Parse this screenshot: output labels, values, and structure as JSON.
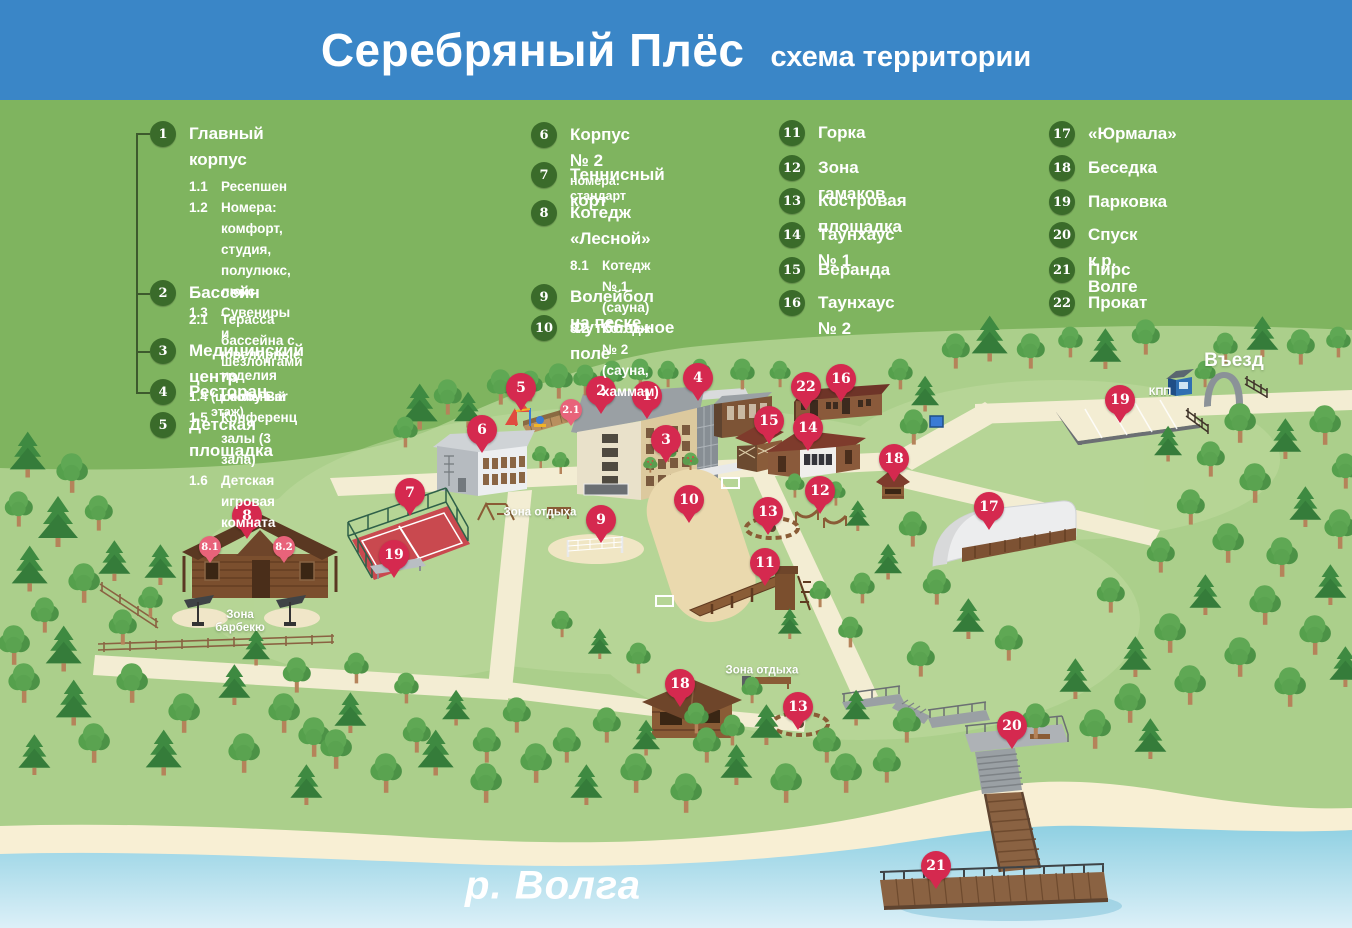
{
  "header": {
    "title": "Серебряный Плёс",
    "subtitle": "схема территории"
  },
  "legend": {
    "columns": [
      {
        "items": [
          {
            "num": "1",
            "label": "Главный корпус",
            "subs": [
              {
                "num": "1.1",
                "label": "Ресепшен"
              },
              {
                "num": "1.2",
                "label": "Номера: комфорт, студия, полулюкс, люкс"
              },
              {
                "num": "1.3",
                "label": "Сувениры и ювелирные изделия"
              },
              {
                "num": "1.4",
                "label": "Lobby Bar"
              },
              {
                "num": "1.5",
                "label": "Конференц залы (3 зала)"
              },
              {
                "num": "1.6",
                "label": "Детская игровая комната"
              }
            ]
          },
          {
            "num": "2",
            "label": "Бассейн",
            "subs": [
              {
                "num": "2.1",
                "label": "Терасса бассейна с шезлонгами"
              }
            ]
          },
          {
            "num": "3",
            "label": "Медицинский центр",
            "note": "(цокольный этаж)"
          },
          {
            "num": "4",
            "label": "Ресторан"
          },
          {
            "num": "5",
            "label": "Детская площадка"
          }
        ]
      },
      {
        "items": [
          {
            "num": "6",
            "label": "Корпус № 2",
            "note": "номера: стандарт"
          },
          {
            "num": "7",
            "label": "Теннисный корт"
          },
          {
            "num": "8",
            "label": "Котедж «Лесной»",
            "subs": [
              {
                "num": "8.1",
                "label": "Котедж № 1 (сауна)"
              },
              {
                "num": "8.2",
                "label": "Котедж № 2\n(сауна, хаммам)"
              }
            ]
          },
          {
            "num": "9",
            "label": "Волейбол на песке"
          },
          {
            "num": "10",
            "label": "Футбольное поле"
          }
        ]
      },
      {
        "items": [
          {
            "num": "11",
            "label": "Горка"
          },
          {
            "num": "12",
            "label": "Зона гамаков"
          },
          {
            "num": "13",
            "label": "Костровая площадка"
          },
          {
            "num": "14",
            "label": "Таунхаус № 1"
          },
          {
            "num": "15",
            "label": "Веранда"
          },
          {
            "num": "16",
            "label": "Таунхаус № 2"
          }
        ]
      },
      {
        "items": [
          {
            "num": "17",
            "label": "«Юрмала»"
          },
          {
            "num": "18",
            "label": "Беседка"
          },
          {
            "num": "19",
            "label": "Парковка"
          },
          {
            "num": "20",
            "label": "Спуск к р. Волге"
          },
          {
            "num": "21",
            "label": "Пирс"
          },
          {
            "num": "22",
            "label": "Прокат"
          }
        ]
      }
    ]
  },
  "map": {
    "markers": [
      {
        "num": "1",
        "x": 647,
        "y": 396
      },
      {
        "num": "2",
        "x": 601,
        "y": 391
      },
      {
        "num": "2.1",
        "x": 571,
        "y": 410,
        "small": true
      },
      {
        "num": "3",
        "x": 666,
        "y": 440
      },
      {
        "num": "4",
        "x": 698,
        "y": 378
      },
      {
        "num": "5",
        "x": 521,
        "y": 388
      },
      {
        "num": "6",
        "x": 482,
        "y": 430
      },
      {
        "num": "7",
        "x": 410,
        "y": 493
      },
      {
        "num": "8",
        "x": 247,
        "y": 516
      },
      {
        "num": "8.1",
        "x": 210,
        "y": 547,
        "small": true
      },
      {
        "num": "8.2",
        "x": 284,
        "y": 547,
        "small": true
      },
      {
        "num": "9",
        "x": 601,
        "y": 520
      },
      {
        "num": "10",
        "x": 689,
        "y": 500
      },
      {
        "num": "11",
        "x": 765,
        "y": 563
      },
      {
        "num": "12",
        "x": 820,
        "y": 491
      },
      {
        "num": "13",
        "x": 768,
        "y": 512
      },
      {
        "num": "13",
        "x": 798,
        "y": 707
      },
      {
        "num": "14",
        "x": 808,
        "y": 428
      },
      {
        "num": "15",
        "x": 769,
        "y": 421
      },
      {
        "num": "16",
        "x": 841,
        "y": 379
      },
      {
        "num": "17",
        "x": 989,
        "y": 507
      },
      {
        "num": "18",
        "x": 894,
        "y": 459
      },
      {
        "num": "18",
        "x": 680,
        "y": 684
      },
      {
        "num": "19",
        "x": 1120,
        "y": 400
      },
      {
        "num": "19",
        "x": 394,
        "y": 555
      },
      {
        "num": "20",
        "x": 1012,
        "y": 726
      },
      {
        "num": "21",
        "x": 936,
        "y": 866
      },
      {
        "num": "22",
        "x": 806,
        "y": 387
      }
    ],
    "area_labels": [
      {
        "text": "Зона отдыха",
        "x": 540,
        "y": 513
      },
      {
        "text": "Зона отдыха",
        "x": 762,
        "y": 671
      },
      {
        "text": "Зона\nбарбекю",
        "x": 240,
        "y": 622
      }
    ],
    "entrance_label": {
      "text": "Въезд",
      "x": 1234,
      "y": 361
    },
    "checkpoint_label": {
      "text": "КПП",
      "x": 1160,
      "y": 392
    },
    "river_label": {
      "text": "р. Волга",
      "x": 553,
      "y": 886
    }
  },
  "colors": {
    "header_blue": "#3a86c7",
    "legend_green": "#7fb45f",
    "map_green": "#abcf8b",
    "badge_green": "#3a6b2a",
    "marker_red": "#d5294f",
    "marker_light_red": "#e8637a",
    "river_blue": "#8fd0e2",
    "sand": "#f8efd4",
    "path_cream": "#f3edd3"
  }
}
